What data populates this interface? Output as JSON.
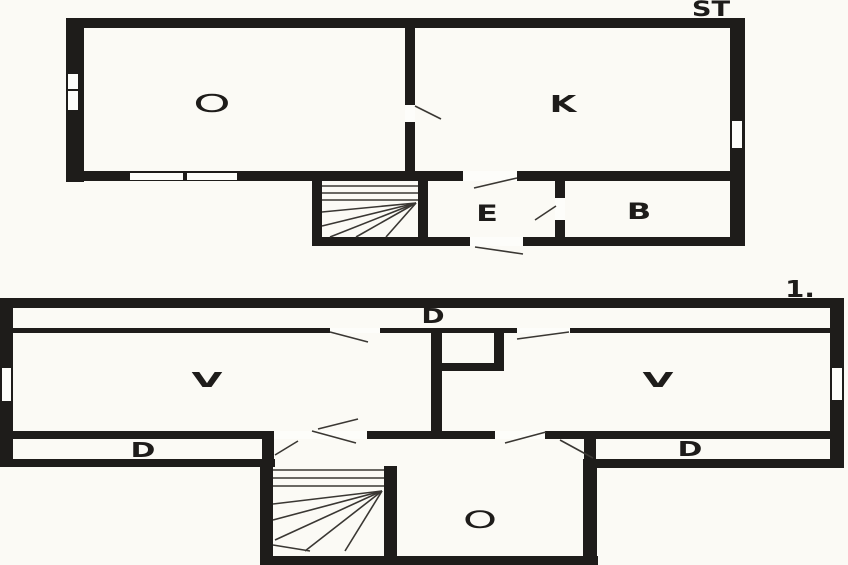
{
  "page": {
    "background": "#fbfaf5",
    "wall_color": "#1e1c1a",
    "opening_color": "#fdfdfa",
    "line_color": "#3a3733",
    "label_color": "#1e1c1a"
  },
  "upper_plan": {
    "floor_label": "ST",
    "rooms": {
      "o": "O",
      "k": "K",
      "e": "E",
      "b": "B"
    }
  },
  "lower_plan": {
    "floor_label": "1.",
    "rooms": {
      "d_top": "D",
      "v_left": "V",
      "v_right": "V",
      "d_left": "D",
      "d_right": "D",
      "o": "O"
    }
  }
}
